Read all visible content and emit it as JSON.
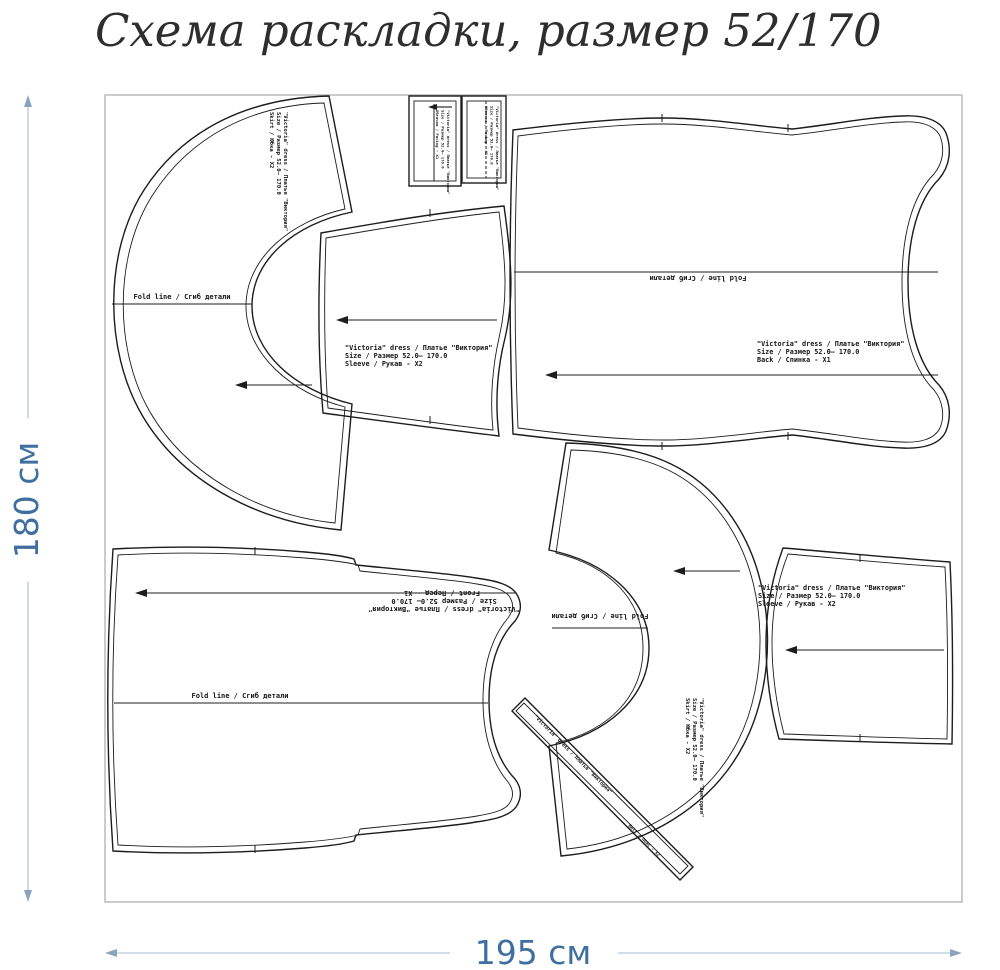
{
  "title": "Схема раскладки, размер 52/170",
  "dimensions": {
    "height": "180 см",
    "width": "195 см"
  },
  "piece_labels": {
    "header": "\"Victoria\" dress / Платье \"Виктория\"",
    "size": "Size / Размер  52.0— 170.0",
    "sleeve": "Sleeve / Рукав - X2",
    "back": "Back / Спинка - X1",
    "front": "Front / Перед - X1",
    "skirt": "Skirt / Юбка - X2",
    "belt": "Belt / Пояс - X2",
    "facing": "Обтачка / Facing - X1",
    "fold_line": "Fold line / Сгиб детали"
  },
  "colors": {
    "outline": "#1c1c1c",
    "fabric_border": "#ababab",
    "dimension_line": "#c2d2df",
    "dimension_text": "#3f6f9e"
  }
}
